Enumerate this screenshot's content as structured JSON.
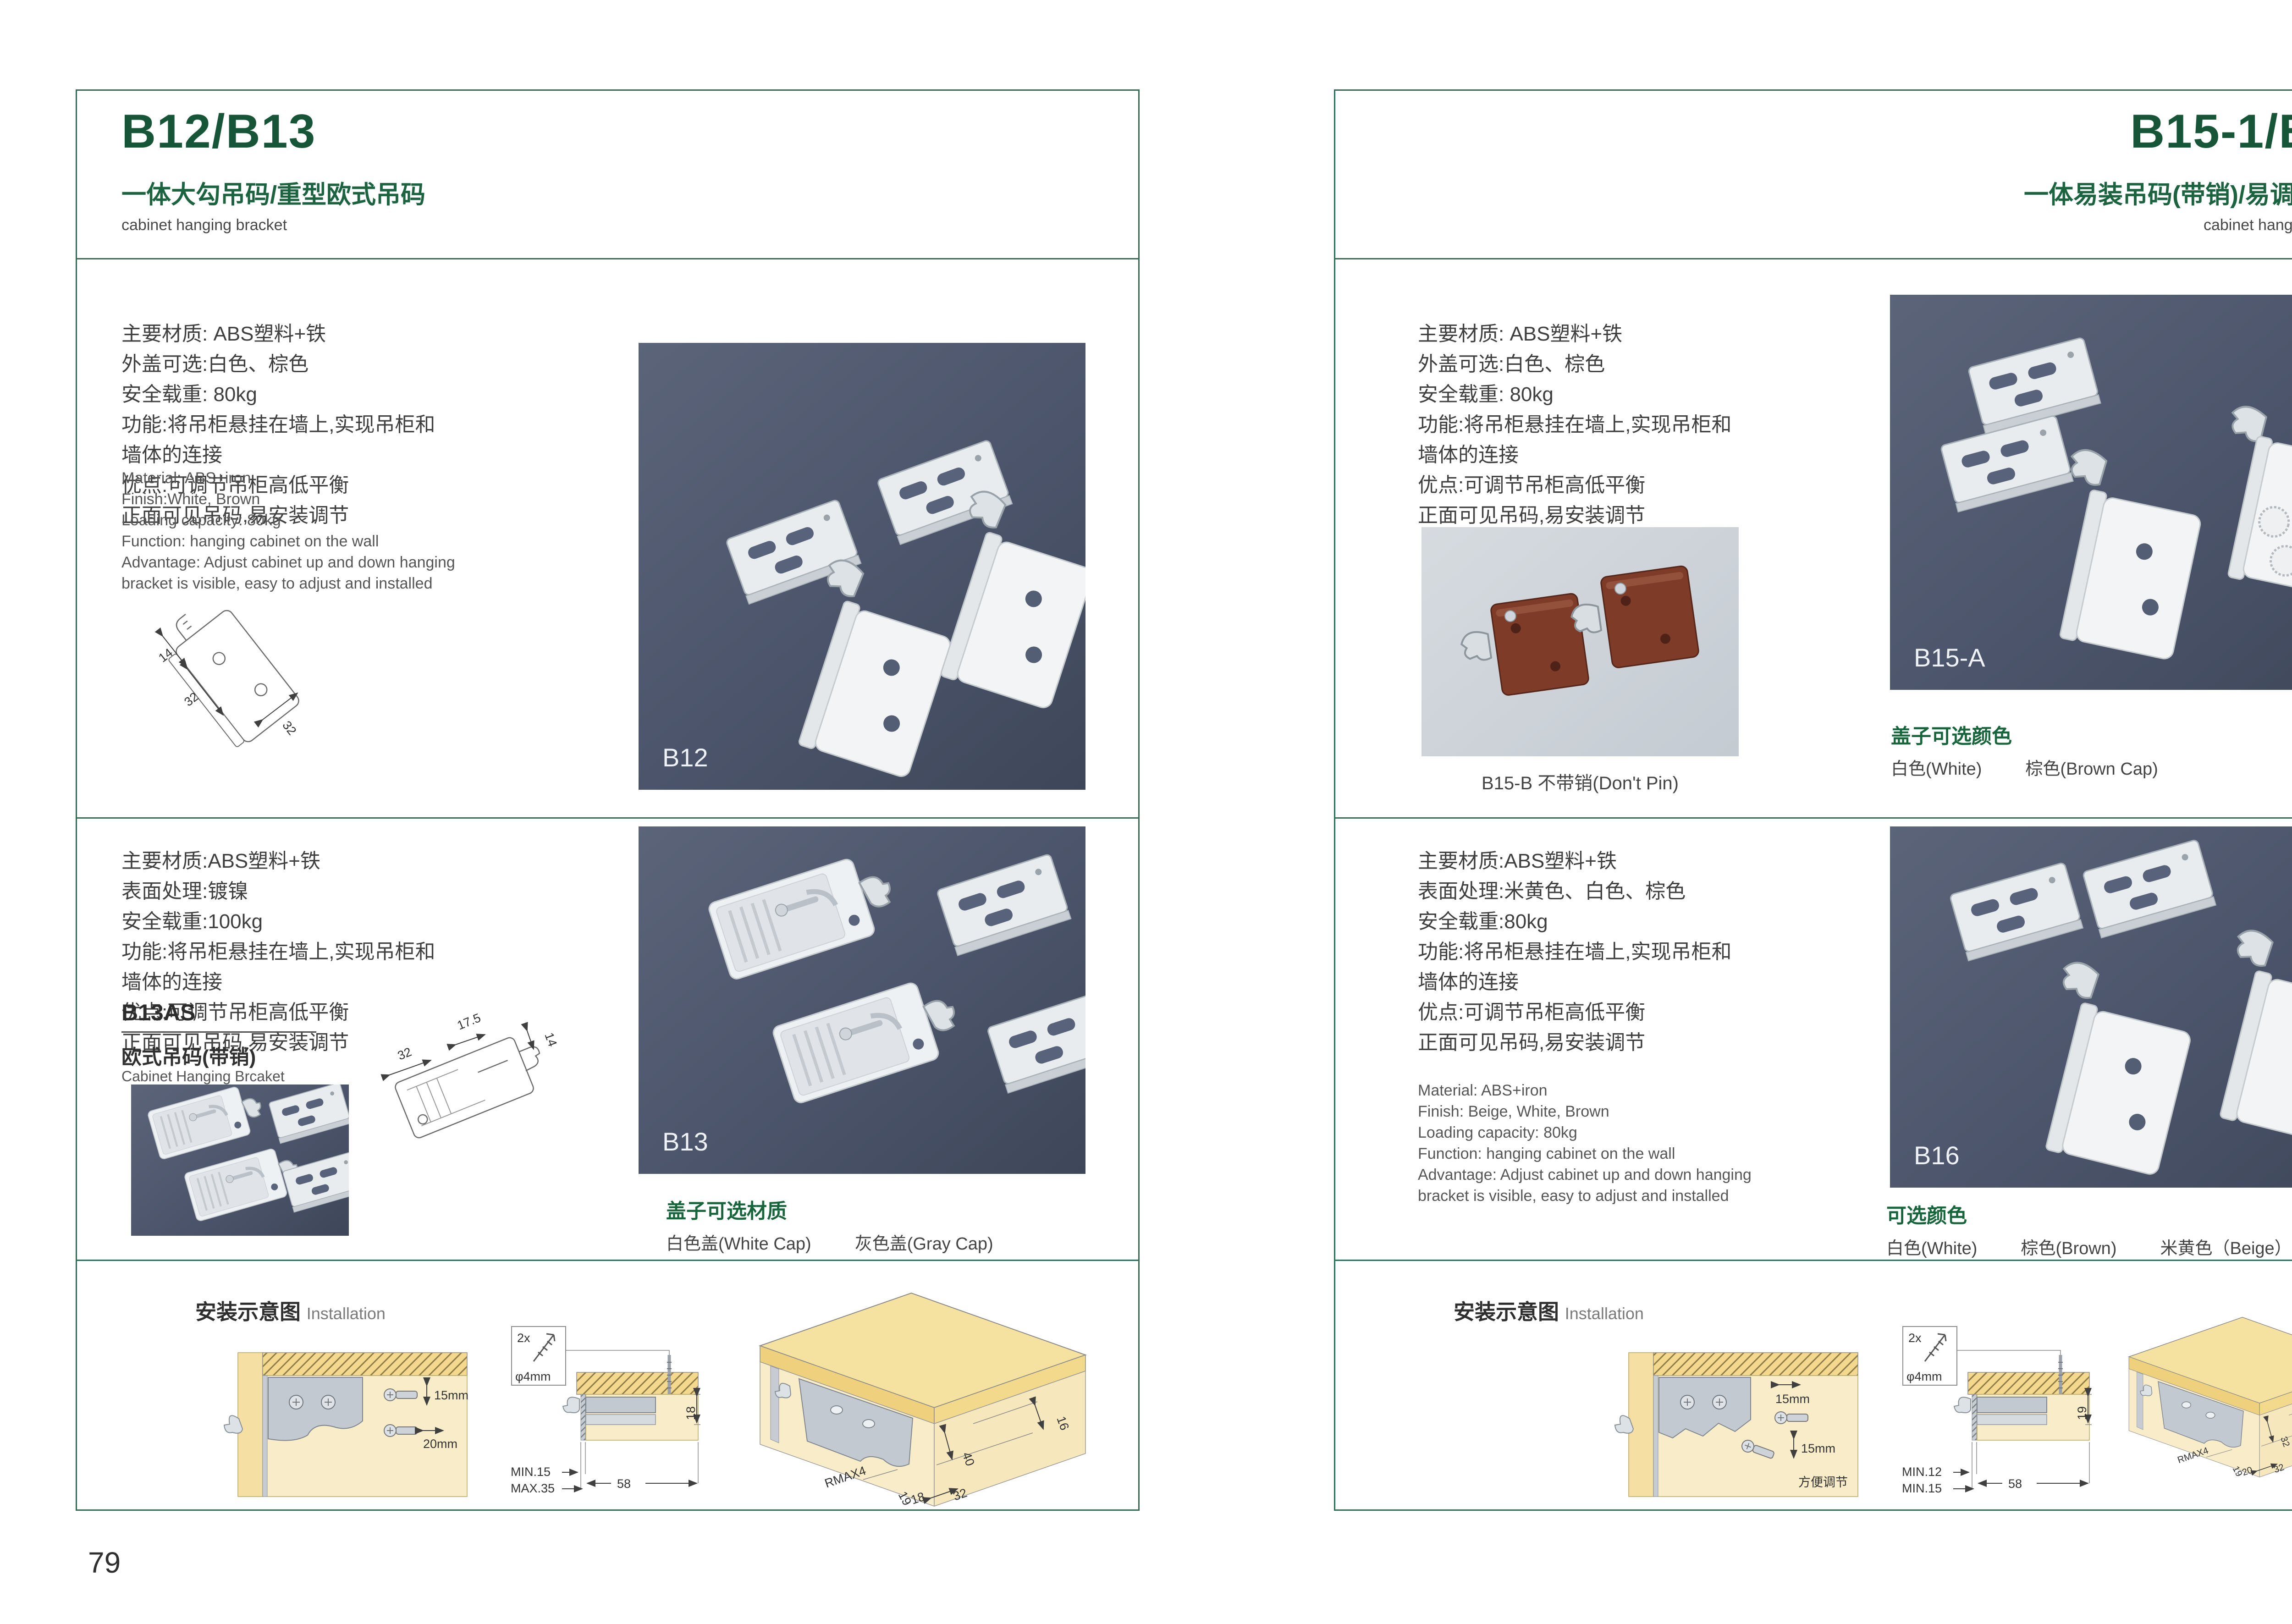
{
  "colors": {
    "accent_green": "#175539",
    "line_green": "#2f6f55",
    "photo_bg": "#4b546a",
    "photo_light_bg": "#c9d0d6",
    "wood_yellow": "#f4d88e",
    "panel_beige": "#f9ecc8",
    "bracket_gray": "#c2c9d0",
    "brown_part": "#7e3b28"
  },
  "left": {
    "title": "B12/B13",
    "subtitle": "一体大勾吊码/重型欧式吊码",
    "hdr_en": "cabinet hanging bracket",
    "page_number": "79",
    "s1": {
      "cn": [
        "主要材质: ABS塑料+铁",
        "外盖可选:白色、棕色",
        "安全载重: 80kg",
        "功能:将吊柜悬挂在墙上,实现吊柜和",
        "墙体的连接",
        "优点:可调节吊柜高低平衡",
        "正面可见吊码,易安装调节"
      ],
      "en": [
        "Material: ABS+iron",
        "Finish:White, Brown",
        "Loading capacity: 80kg",
        "Function: hanging cabinet on the wall",
        "Advantage: Adjust cabinet up and down hanging",
        "bracket is visible, easy to adjust and installed"
      ],
      "ld": [
        "14",
        "32",
        "32"
      ],
      "photo_label": "B12"
    },
    "s2": {
      "cn": [
        "主要材质:ABS塑料+铁",
        "表面处理:镀镍",
        "安全载重:100kg",
        "功能:将吊柜悬挂在墙上,实现吊柜和",
        "墙体的连接",
        "优点:可调节吊柜高低平衡",
        "正面可见吊码,易安装调节"
      ],
      "model": "B13AS",
      "model_cn": "欧式吊码(带销)",
      "model_en": "Cabinet Hanging Brcaket",
      "ld": [
        "32",
        "17.5",
        "14"
      ],
      "photo_label": "B13",
      "cap_title": "盖子可选材质",
      "cap_opts": [
        "白色盖(White Cap)",
        "灰色盖(Gray Cap)"
      ]
    },
    "install": {
      "hdr_cn": "安装示意图",
      "hdr_en": "Installation",
      "d1": {
        "v": "15mm",
        "h": "20mm"
      },
      "d2": {
        "qty": "2x",
        "dia": "φ4mm",
        "side": "18",
        "lim1": "MIN.15",
        "lim2": "MAX.35",
        "w": "58"
      },
      "d3": {
        "a": "16",
        "b": "40",
        "r": "RMAX4",
        "c": "19",
        "d": "18",
        "e": "32"
      }
    }
  },
  "right": {
    "title": "B15-1/B16",
    "subtitle": "一体易装吊码(带销)/易调节吊码",
    "hdr_en": "cabinet hanging bracket",
    "page_number": "80",
    "s1": {
      "cn": [
        "主要材质: ABS塑料+铁",
        "外盖可选:白色、棕色",
        "安全载重: 80kg",
        "功能:将吊柜悬挂在墙上,实现吊柜和",
        "墙体的连接",
        "优点:可调节吊柜高低平衡",
        "正面可见吊码,易安装调节"
      ],
      "small_caption": "B15-B 不带销(Don't Pin)",
      "photo_label": "B15-A",
      "cap_title": "盖子可选颜色",
      "cap_opts": [
        "白色(White)",
        "棕色(Brown Cap)"
      ]
    },
    "s2": {
      "cn": [
        "主要材质:ABS塑料+铁",
        "表面处理:米黄色、白色、棕色",
        "安全载重:80kg",
        "功能:将吊柜悬挂在墙上,实现吊柜和",
        "墙体的连接",
        "优点:可调节吊柜高低平衡",
        "正面可见吊码,易安装调节"
      ],
      "en": [
        "Material: ABS+iron",
        "Finish: Beige, White, Brown",
        "Loading capacity: 80kg",
        "Function: hanging cabinet on the wall",
        "Advantage: Adjust cabinet up and down hanging",
        "bracket is visible, easy to adjust and installed"
      ],
      "photo_label": "B16",
      "cap_title": "可选颜色",
      "cap_opts": [
        "白色(White)",
        "棕色(Brown)",
        "米黄色（Beige）"
      ]
    },
    "install": {
      "hdr_cn": "安装示意图",
      "hdr_en": "Installation",
      "d1": {
        "h": "15mm",
        "v": "15mm",
        "note": "方便调节"
      },
      "d2": {
        "qty": "2x",
        "dia": "φ4mm",
        "side": "19",
        "lim1": "MIN.12",
        "lim2": "MIN.15",
        "w": "58"
      },
      "d3": {
        "a": "30",
        "b": "32",
        "r": "RMAX4",
        "c": "19",
        "d": "20",
        "e": "32"
      }
    }
  }
}
